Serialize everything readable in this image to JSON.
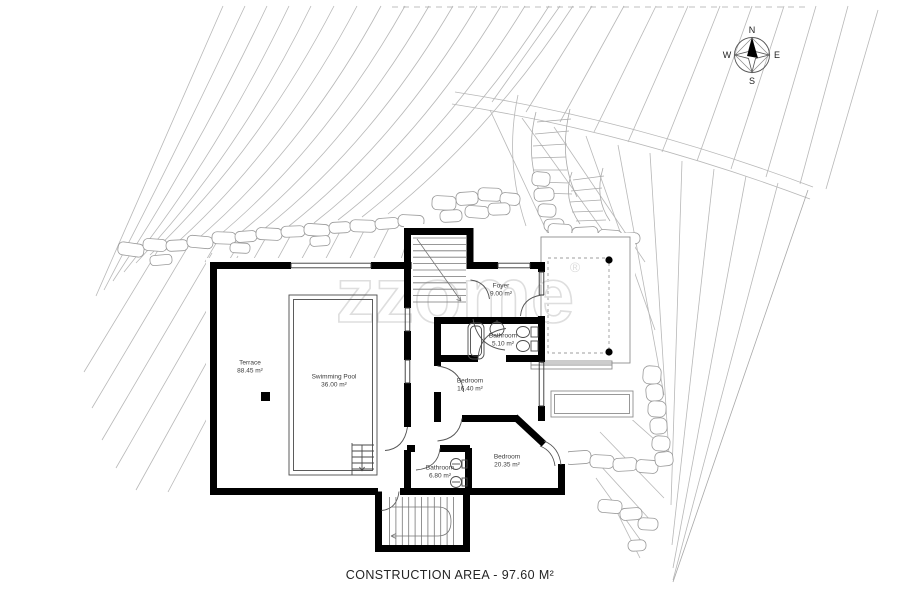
{
  "watermark": {
    "brand": "zzome",
    "registered": "®"
  },
  "compass": {
    "north": "N",
    "east": "E",
    "south": "S",
    "west": "W"
  },
  "rooms": [
    {
      "id": "terrace",
      "name": "Terrace",
      "area": "88.45 m²"
    },
    {
      "id": "swimming-pool",
      "name": "Swimming Pool",
      "area": "36.00 m²"
    },
    {
      "id": "foyer",
      "name": "Foyer",
      "area": "9.00 m²"
    },
    {
      "id": "bathroom-upper",
      "name": "Bathroom",
      "area": "5.10 m²"
    },
    {
      "id": "bedroom-1",
      "name": "Bedroom",
      "area": "16.40 m²"
    },
    {
      "id": "bathroom-lower",
      "name": "Bathroom",
      "area": "6.80 m²"
    },
    {
      "id": "bedroom-2",
      "name": "Bedroom",
      "area": "20.35 m²"
    }
  ],
  "footer": {
    "caption": "CONSTRUCTION AREA - 97.60 M²"
  },
  "colors": {
    "wall": "#000000",
    "terrain": "#b8b8b8",
    "stone": "#9a9a9a",
    "detail": "#555555",
    "watermark": "#dedede"
  }
}
